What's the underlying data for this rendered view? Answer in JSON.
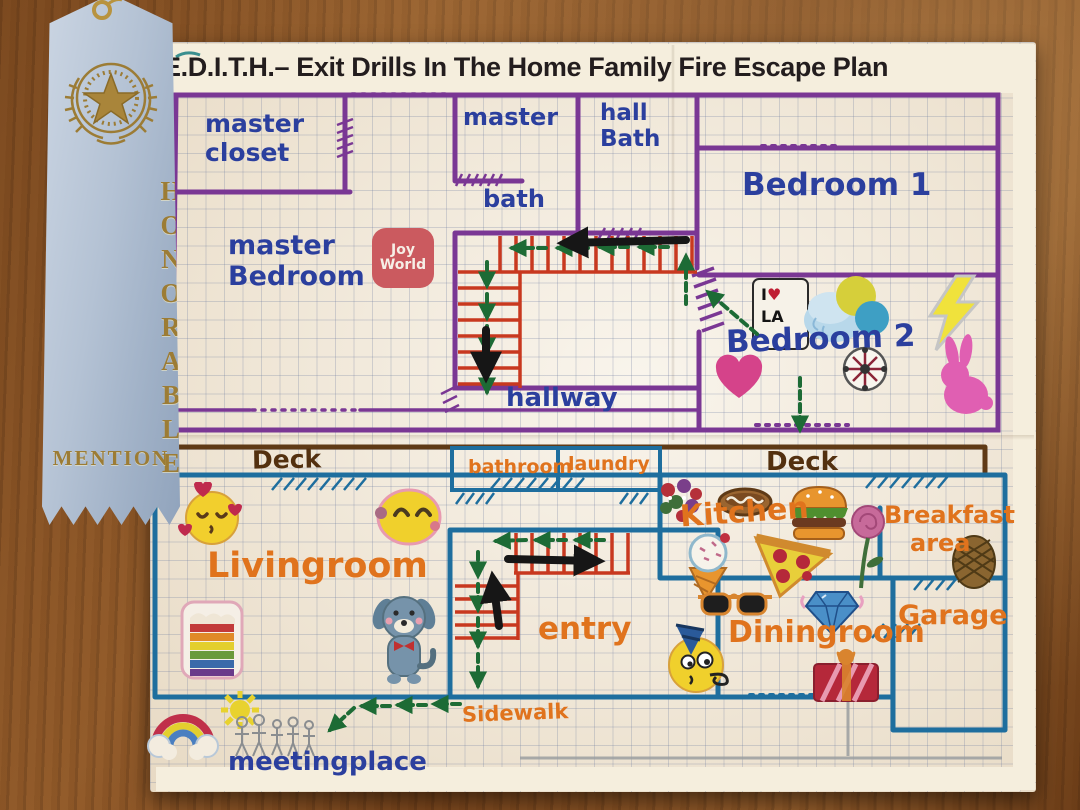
{
  "title": "E.D.I.T.H.– Exit Drills In The Home Family Fire Escape Plan",
  "ribbon": {
    "vertical_word": "HONORABLE",
    "bottom_word": "MENTION"
  },
  "upper_floor": {
    "master_closet_line1": "master",
    "master_closet_line2": "closet",
    "master_bedroom_line1": "master",
    "master_bedroom_line2": "Bedroom",
    "master_bath_line1": "master",
    "master_bath_line2": "bath",
    "hall_bath_line1": "hall",
    "hall_bath_line2": "Bath",
    "bedroom1": "Bedroom 1",
    "bedroom2": "Bedroom 2",
    "hallway": "hallway"
  },
  "lower_floor": {
    "deck_left": "Deck",
    "deck_right": "Deck",
    "bathroom": "bathroom",
    "laundry": "laundry",
    "livingroom": "Livingroom",
    "kitchen": "Kitchen",
    "breakfast_line1": "Breakfast",
    "breakfast_line2": "area",
    "entry": "entry",
    "diningroom": "Diningroom",
    "garage": "Garage",
    "sidewalk": "Sidewalk",
    "meetingplace": "meetingplace"
  },
  "stickers": {
    "joy_world_line1": "Joy",
    "joy_world_line2": "World",
    "i_love_la_line1": "I",
    "i_love_la_heart": "♥",
    "i_love_la_line2": "LA",
    "names": [
      "heart-kiss-emoji",
      "smile-emoji",
      "rainbow-cake",
      "blue-dog",
      "flower-bouquet",
      "hot-dog",
      "burger",
      "ice-cream-cone",
      "pizza-slice",
      "rose",
      "pinecone",
      "sunglasses",
      "diamond",
      "party-emoji",
      "present",
      "cloud-balloons",
      "lightning-bolt",
      "pink-heart",
      "snowflake-ornament",
      "pink-bunny",
      "rainbow-cloud",
      "sun-doodle",
      "stick-figure-family"
    ]
  },
  "colors": {
    "purple_wall": "#7a3794",
    "blue_wall": "#1e6e9e",
    "stair_red": "#c8381f",
    "route_green": "#1d6b35",
    "label_orange": "#e0731d",
    "label_blue": "#2b3f9e",
    "deck_brown": "#5f3a16",
    "ribbon_blue": "#b9c6d8",
    "ribbon_gold": "#9c7c35",
    "paper": "#f3ead9"
  }
}
